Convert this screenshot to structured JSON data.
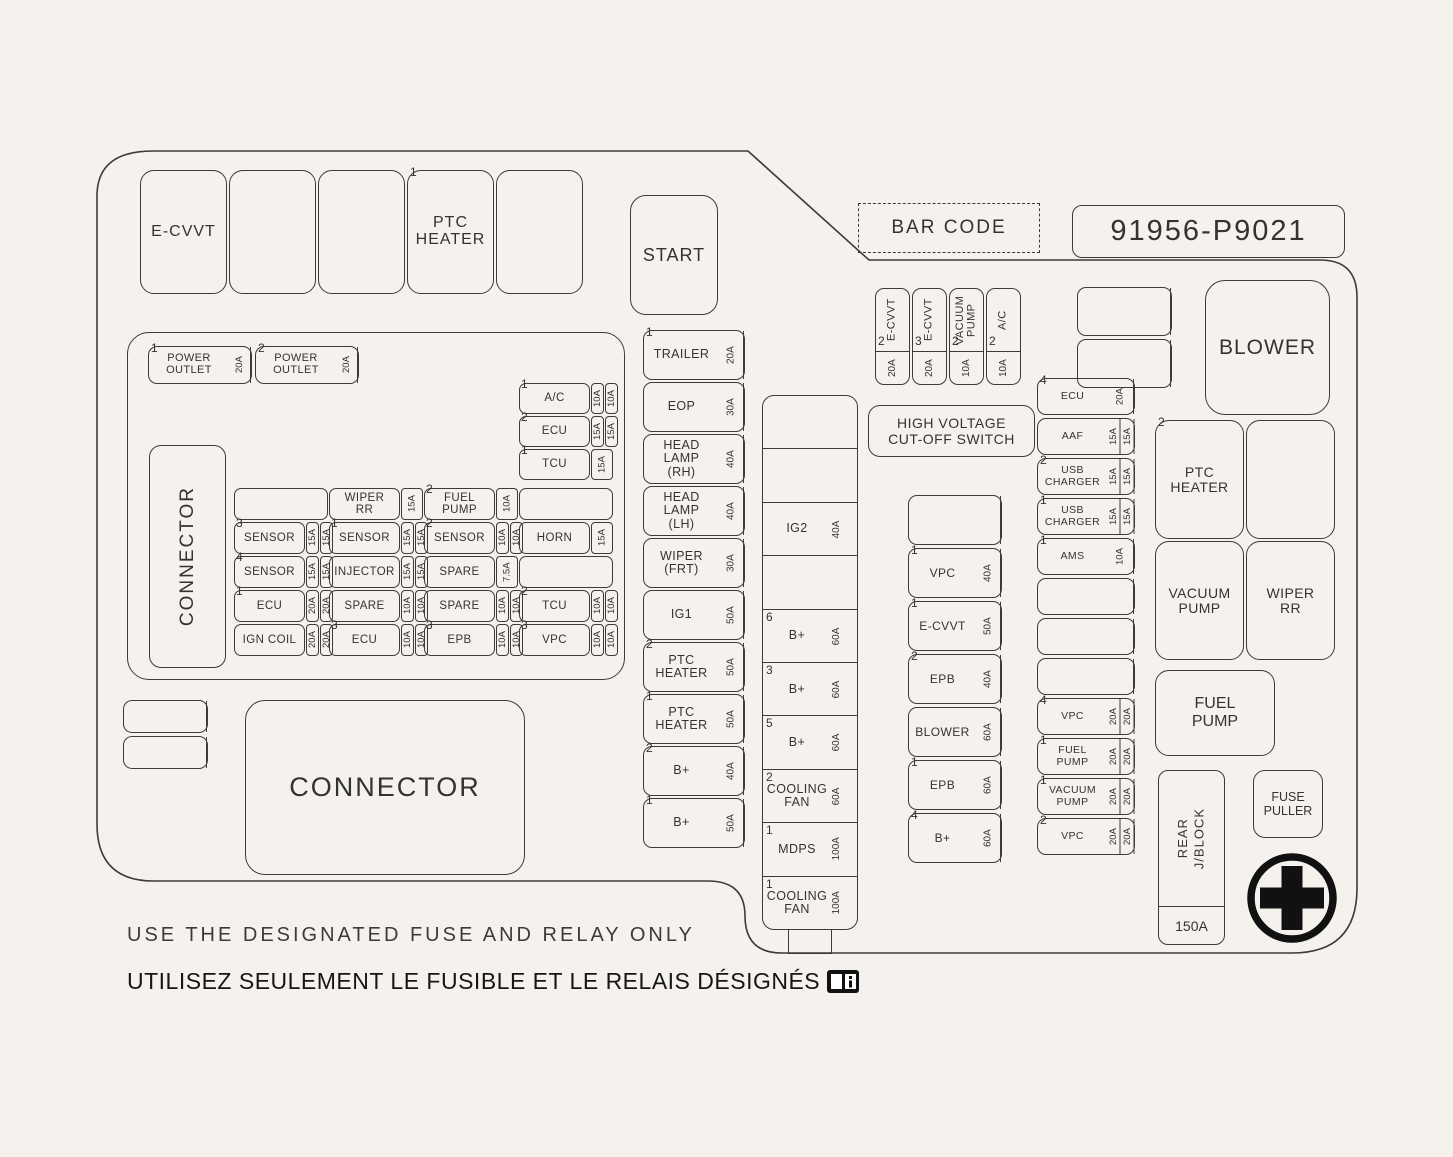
{
  "colors": {
    "background": "#f5f2ee",
    "line": "#3b3b3b",
    "text": "#333333",
    "symbol": "#111111"
  },
  "top_area": {
    "relays": [
      {
        "label": "E-CVVT"
      },
      {
        "label": ""
      },
      {
        "label": ""
      },
      {
        "sup": "1",
        "label": "PTC\nHEATER"
      },
      {
        "label": ""
      }
    ],
    "start_relay": {
      "label": "START"
    },
    "barcode": {
      "label": "BAR CODE"
    },
    "part_number": {
      "label": "91956-P9021"
    },
    "blower_relay": {
      "label": "BLOWER"
    },
    "hv_switch": {
      "label": "HIGH VOLTAGE\nCUT-OFF SWITCH"
    }
  },
  "cvvt_fuses": [
    {
      "sup": "2",
      "label": "E-CVVT",
      "amps": [
        "20A"
      ]
    },
    {
      "sup": "3",
      "label": "E-CVVT",
      "amps": [
        "20A"
      ]
    },
    {
      "sup": "2",
      "label": "VACUUM\nPUMP",
      "amps": [
        "10A"
      ]
    },
    {
      "sup": "2",
      "label": "A/C",
      "amps": [
        "10A"
      ]
    }
  ],
  "blank_pair": [
    {
      "label": "",
      "amps": [
        ""
      ]
    },
    {
      "label": "",
      "amps": [
        ""
      ]
    }
  ],
  "left_panel": {
    "power_outlets": [
      {
        "sup": "1",
        "label": "POWER\nOUTLET",
        "amps": [
          "20A"
        ]
      },
      {
        "sup": "2",
        "label": "POWER\nOUTLET",
        "amps": [
          "20A"
        ]
      }
    ],
    "connector_label": "CONNECTOR",
    "ac_column": [
      {
        "sup": "1",
        "label": "A/C",
        "amps": [
          "10A",
          "10A"
        ]
      },
      {
        "sup": "2",
        "label": "ECU",
        "amps": [
          "15A",
          "15A"
        ]
      },
      {
        "sup": "1",
        "label": "TCU",
        "amps": [
          "15A"
        ]
      }
    ],
    "grid_rows": [
      [
        {
          "label": "",
          "amps": []
        },
        {
          "label": "WIPER\nRR",
          "amps": [
            "15A"
          ]
        },
        {
          "sup": "2",
          "label": "FUEL\nPUMP",
          "amps": [
            "10A"
          ]
        },
        {
          "label": "",
          "amps": []
        }
      ],
      [
        {
          "sup": "3",
          "label": "SENSOR",
          "amps": [
            "15A",
            "15A"
          ]
        },
        {
          "sup": "1",
          "label": "SENSOR",
          "amps": [
            "15A",
            "15A"
          ]
        },
        {
          "sup": "2",
          "label": "SENSOR",
          "amps": [
            "10A",
            "10A"
          ]
        },
        {
          "label": "HORN",
          "amps": [
            "15A"
          ]
        }
      ],
      [
        {
          "sup": "4",
          "label": "SENSOR",
          "amps": [
            "15A",
            "15A"
          ]
        },
        {
          "label": "INJECTOR",
          "amps": [
            "15A",
            "15A"
          ]
        },
        {
          "label": "SPARE",
          "amps": [
            "7.5A"
          ]
        },
        {
          "label": "",
          "amps": []
        }
      ],
      [
        {
          "sup": "1",
          "label": "ECU",
          "amps": [
            "20A",
            "20A"
          ]
        },
        {
          "label": "SPARE",
          "amps": [
            "10A",
            "10A"
          ]
        },
        {
          "label": "SPARE",
          "amps": [
            "10A",
            "10A"
          ]
        },
        {
          "sup": "2",
          "label": "TCU",
          "amps": [
            "10A",
            "10A"
          ]
        }
      ],
      [
        {
          "label": "IGN COIL",
          "amps": [
            "20A",
            "20A"
          ]
        },
        {
          "sup": "3",
          "label": "ECU",
          "amps": [
            "10A",
            "10A"
          ]
        },
        {
          "sup": "3",
          "label": "EPB",
          "amps": [
            "10A",
            "10A"
          ]
        },
        {
          "sup": "3",
          "label": "VPC",
          "amps": [
            "10A",
            "10A"
          ]
        }
      ]
    ]
  },
  "small_pair": [
    {
      "label": "",
      "amps": [
        ""
      ]
    },
    {
      "label": "",
      "amps": [
        ""
      ]
    }
  ],
  "connector_box": {
    "label": "CONNECTOR"
  },
  "mid_column": [
    {
      "sup": "1",
      "label": "TRAILER",
      "amps": [
        "20A"
      ]
    },
    {
      "label": "EOP",
      "amps": [
        "30A"
      ]
    },
    {
      "label": "HEAD\nLAMP\n(RH)",
      "amps": [
        "40A"
      ]
    },
    {
      "label": "HEAD\nLAMP\n(LH)",
      "amps": [
        "40A"
      ]
    },
    {
      "label": "WIPER\n(FRT)",
      "amps": [
        "30A"
      ]
    },
    {
      "label": "IG1",
      "amps": [
        "50A"
      ]
    },
    {
      "sup": "2",
      "label": "PTC\nHEATER",
      "amps": [
        "50A"
      ]
    },
    {
      "sup": "1",
      "label": "PTC\nHEATER",
      "amps": [
        "50A"
      ]
    },
    {
      "sup": "2",
      "label": "B+",
      "amps": [
        "40A"
      ]
    },
    {
      "sup": "1",
      "label": "B+",
      "amps": [
        "50A"
      ]
    }
  ],
  "ig2_column": [
    {
      "label": "",
      "amps": [
        ""
      ]
    },
    {
      "label": "",
      "amps": [
        ""
      ]
    },
    {
      "label": "IG2",
      "amps": [
        "40A"
      ]
    },
    {
      "label": "",
      "amps": [
        ""
      ]
    },
    {
      "sup": "6",
      "label": "B+",
      "amps": [
        "60A"
      ]
    },
    {
      "sup": "3",
      "label": "B+",
      "amps": [
        "60A"
      ]
    },
    {
      "sup": "5",
      "label": "B+",
      "amps": [
        "60A"
      ]
    },
    {
      "sup": "2",
      "label": "COOLING\nFAN",
      "amps": [
        "60A"
      ]
    },
    {
      "sup": "1",
      "label": "MDPS",
      "amps": [
        "100A"
      ]
    },
    {
      "sup": "1",
      "label": "COOLING\nFAN",
      "amps": [
        "100A"
      ]
    }
  ],
  "vpc_column": [
    {
      "label": "",
      "amps": [
        ""
      ]
    },
    {
      "sup": "1",
      "label": "VPC",
      "amps": [
        "40A"
      ]
    },
    {
      "sup": "1",
      "label": "E-CVVT",
      "amps": [
        "50A"
      ]
    },
    {
      "sup": "2",
      "label": "EPB",
      "amps": [
        "40A"
      ]
    },
    {
      "label": "BLOWER",
      "amps": [
        "60A"
      ]
    },
    {
      "sup": "1",
      "label": "EPB",
      "amps": [
        "60A"
      ]
    },
    {
      "sup": "4",
      "label": "B+",
      "amps": [
        "60A"
      ]
    }
  ],
  "ecu_column": [
    {
      "sup": "4",
      "label": "ECU",
      "amps": [
        "20A"
      ]
    },
    {
      "label": "AAF",
      "amps": [
        "15A",
        "15A"
      ]
    },
    {
      "sup": "2",
      "label": "USB\nCHARGER",
      "amps": [
        "15A",
        "15A"
      ]
    },
    {
      "sup": "1",
      "label": "USB\nCHARGER",
      "amps": [
        "15A",
        "15A"
      ]
    },
    {
      "sup": "1",
      "label": "AMS",
      "amps": [
        "10A"
      ]
    },
    {
      "label": "",
      "amps": [
        ""
      ]
    },
    {
      "label": "",
      "amps": [
        ""
      ]
    },
    {
      "label": "",
      "amps": [
        ""
      ]
    },
    {
      "sup": "4",
      "label": "VPC",
      "amps": [
        "20A",
        "20A"
      ]
    },
    {
      "sup": "1",
      "label": "FUEL\nPUMP",
      "amps": [
        "20A",
        "20A"
      ]
    },
    {
      "sup": "1",
      "label": "VACUUM\nPUMP",
      "amps": [
        "20A",
        "20A"
      ]
    },
    {
      "sup": "2",
      "label": "VPC",
      "amps": [
        "20A",
        "20A"
      ]
    }
  ],
  "right_relays": {
    "quad": [
      {
        "sup": "2",
        "label": "PTC\nHEATER"
      },
      {
        "label": ""
      },
      {
        "label": "VACUUM\nPUMP"
      },
      {
        "label": "WIPER\nRR"
      }
    ],
    "fuel_pump": {
      "label": "FUEL\nPUMP"
    },
    "rear_jblock": {
      "label": "REAR\nJ/BLOCK",
      "amp": "150A"
    },
    "fuse_puller": {
      "label": "FUSE\nPULLER"
    }
  },
  "symbols": {
    "cross": "fuse-puller-cross-icon",
    "book": "owners-manual-book-icon"
  },
  "footer": {
    "line_en": "USE THE DESIGNATED FUSE AND RELAY ONLY",
    "line_fr": "UTILISEZ SEULEMENT LE FUSIBLE ET LE RELAIS DÉSIGNÉS"
  }
}
